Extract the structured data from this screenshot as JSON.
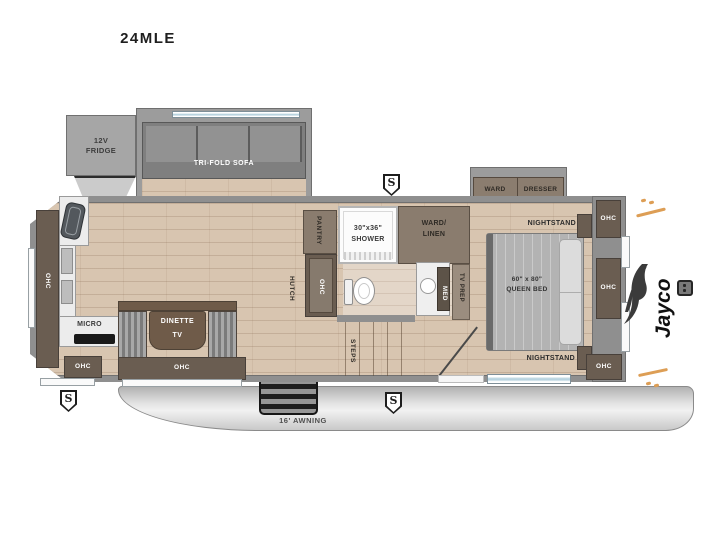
{
  "title": "24MLE",
  "brand": {
    "logo": "Jayco"
  },
  "badges": {
    "speaker": "S"
  },
  "exterior": {
    "awning": "16' AWNING"
  },
  "labels": {
    "fridge_l1": "12V",
    "fridge_l2": "FRIDGE",
    "sofa": "TRI-FOLD SOFA",
    "pantry": "PANTRY",
    "shower_size": "30\"x36\"",
    "shower": "SHOWER",
    "ward_linen_l1": "WARD/",
    "ward_linen_l2": "LINEN",
    "hutch": "HUTCH",
    "ohc": "OHC",
    "micro": "MICRO",
    "dinette": "DINETTE",
    "tv": "TV",
    "steps": "STEPS",
    "med": "MED",
    "tv_prep": "TV PREP",
    "ward": "WARD",
    "dresser": "DRESSER",
    "nightstand": "NIGHTSTAND",
    "bed_size": "60\" x 80\"",
    "bed": "QUEEN BED"
  }
}
